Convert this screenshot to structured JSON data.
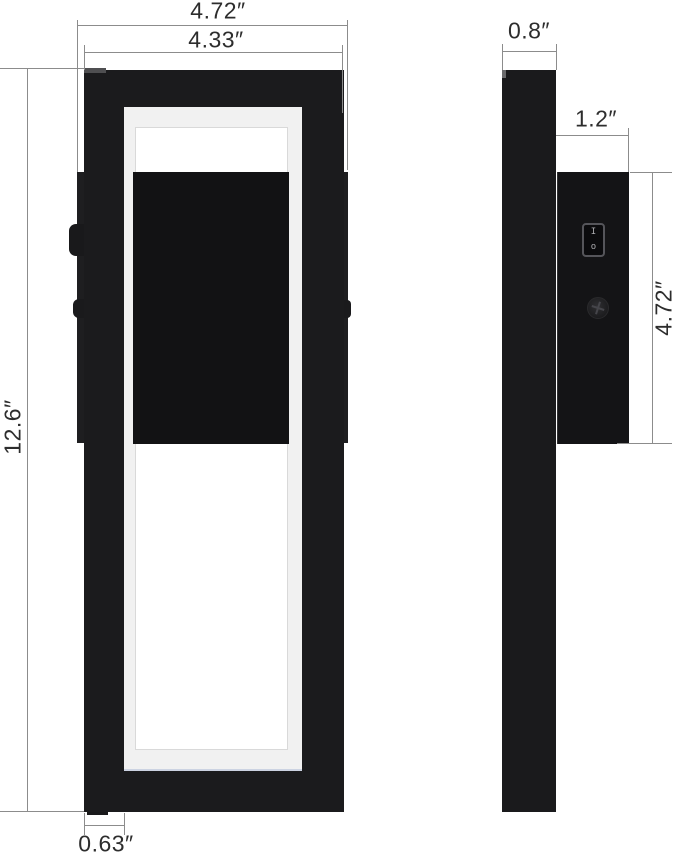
{
  "dims": {
    "front_overall_width": "4.72″",
    "front_frame_width": "4.33″",
    "front_height": "12.6″",
    "front_frame_border": "0.63″",
    "side_depth": "0.8″",
    "side_box_depth": "1.2″",
    "side_box_height": "4.72″"
  },
  "switch": {
    "on_mark": "I",
    "off_mark": "o"
  },
  "colors": {
    "background": "#ffffff",
    "lamp_black": "#1b1b1d",
    "inner_panel_black": "#121214",
    "ring_white": "#f1f1f1",
    "ring_accent": "#ccd3e2",
    "dimension_line": "#8c8c8c",
    "label_text": "#2d2d2d"
  }
}
